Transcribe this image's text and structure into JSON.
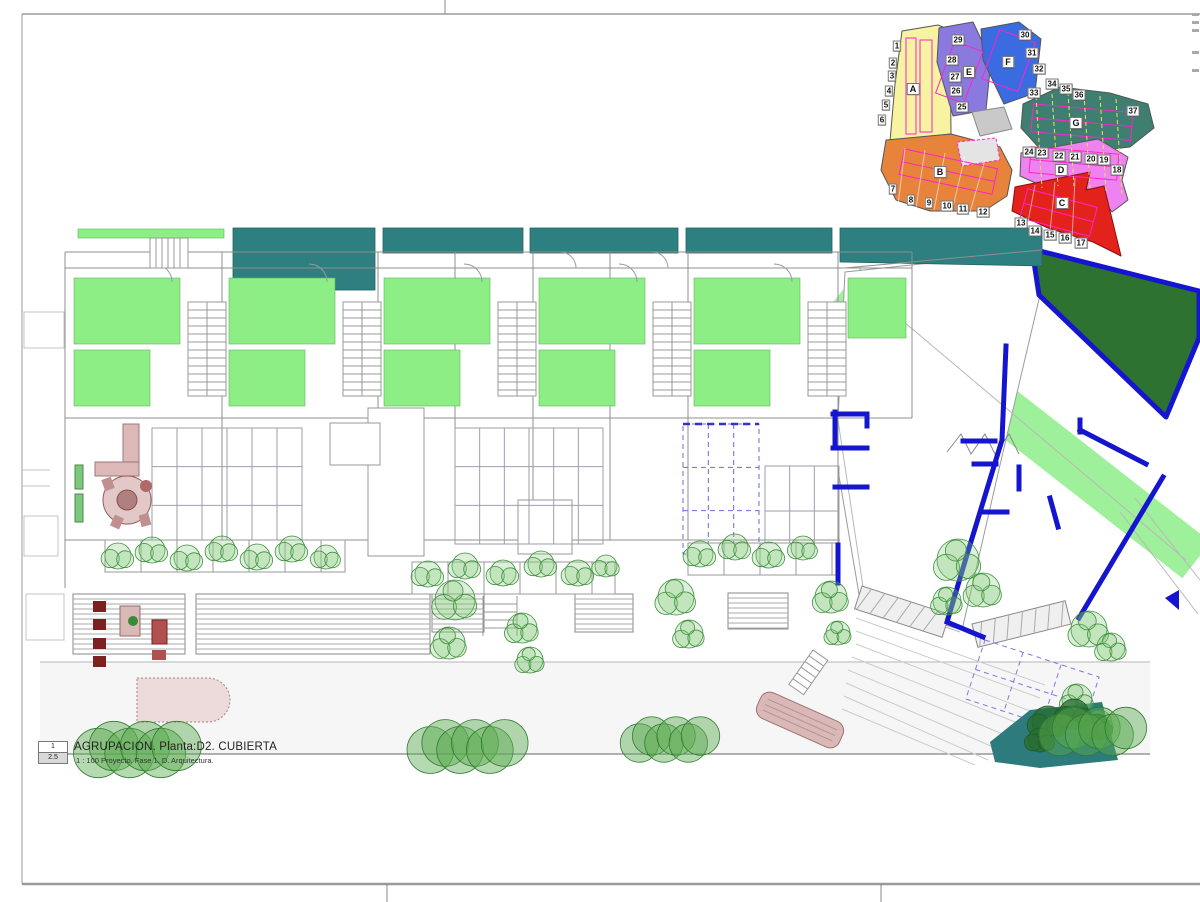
{
  "title_block": {
    "detail_number": "1",
    "scale_code": "2.5",
    "title": "AGRUPACION. Planta:D2. CUBIERTA",
    "subtitle": "1 : 100 Proyecto. Fase 1. D. Arquitectura."
  },
  "colors": {
    "teal_roof": "#2e7f80",
    "roof_green": "#8dee86",
    "lawn_green": "#9ff09a",
    "dark_green": "#2e7231",
    "accent_blue": "#1515cf",
    "pergola_dash_blue": "#6a6ade",
    "magenta_outline": "#ff22cc",
    "zone_a_yellow": "#f7f3a0",
    "zone_b_orange": "#e8833c",
    "zone_c_red": "#e3221c",
    "zone_d_violet": "#ee82ee",
    "zone_e_purple": "#8a7adf",
    "zone_f_blue": "#3a6be0",
    "zone_g_teal": "#3e7f72",
    "pool_pink": "#eddada",
    "furniture_rosy": "#d9b8b8"
  },
  "key_plan": {
    "zone_letters": [
      {
        "label": "A",
        "x": 913,
        "y": 89
      },
      {
        "label": "B",
        "x": 940,
        "y": 172
      },
      {
        "label": "C",
        "x": 1062,
        "y": 203
      },
      {
        "label": "D",
        "x": 1061,
        "y": 170
      },
      {
        "label": "E",
        "x": 969,
        "y": 72
      },
      {
        "label": "F",
        "x": 1008,
        "y": 62
      },
      {
        "label": "G",
        "x": 1076,
        "y": 123
      }
    ],
    "lot_tags": [
      {
        "n": "1",
        "x": 897,
        "y": 46
      },
      {
        "n": "2",
        "x": 893,
        "y": 63
      },
      {
        "n": "3",
        "x": 892,
        "y": 76
      },
      {
        "n": "4",
        "x": 889,
        "y": 91
      },
      {
        "n": "5",
        "x": 886,
        "y": 105
      },
      {
        "n": "6",
        "x": 882,
        "y": 120
      },
      {
        "n": "7",
        "x": 893,
        "y": 189
      },
      {
        "n": "8",
        "x": 911,
        "y": 200
      },
      {
        "n": "9",
        "x": 929,
        "y": 203
      },
      {
        "n": "10",
        "x": 947,
        "y": 206
      },
      {
        "n": "11",
        "x": 963,
        "y": 209
      },
      {
        "n": "12",
        "x": 983,
        "y": 212
      },
      {
        "n": "13",
        "x": 1021,
        "y": 223
      },
      {
        "n": "14",
        "x": 1035,
        "y": 231
      },
      {
        "n": "15",
        "x": 1050,
        "y": 235
      },
      {
        "n": "16",
        "x": 1065,
        "y": 238
      },
      {
        "n": "17",
        "x": 1081,
        "y": 243
      },
      {
        "n": "18",
        "x": 1117,
        "y": 170
      },
      {
        "n": "19",
        "x": 1104,
        "y": 160
      },
      {
        "n": "20",
        "x": 1091,
        "y": 159
      },
      {
        "n": "21",
        "x": 1075,
        "y": 157
      },
      {
        "n": "22",
        "x": 1059,
        "y": 156
      },
      {
        "n": "23",
        "x": 1042,
        "y": 153
      },
      {
        "n": "24",
        "x": 1029,
        "y": 152
      },
      {
        "n": "25",
        "x": 962,
        "y": 107
      },
      {
        "n": "26",
        "x": 956,
        "y": 91
      },
      {
        "n": "27",
        "x": 955,
        "y": 77
      },
      {
        "n": "28",
        "x": 952,
        "y": 60
      },
      {
        "n": "29",
        "x": 958,
        "y": 40
      },
      {
        "n": "30",
        "x": 1025,
        "y": 35
      },
      {
        "n": "31",
        "x": 1032,
        "y": 53
      },
      {
        "n": "32",
        "x": 1039,
        "y": 69
      },
      {
        "n": "33",
        "x": 1034,
        "y": 93
      },
      {
        "n": "34",
        "x": 1052,
        "y": 84
      },
      {
        "n": "35",
        "x": 1066,
        "y": 89
      },
      {
        "n": "36",
        "x": 1079,
        "y": 95
      },
      {
        "n": "37",
        "x": 1133,
        "y": 111
      }
    ]
  },
  "plan": {
    "grids": [
      {
        "x": 152,
        "y": 428,
        "w": 150,
        "h": 116,
        "cols": 6,
        "rows": 3,
        "dashed": false
      },
      {
        "x": 455,
        "y": 428,
        "w": 148,
        "h": 116,
        "cols": 6,
        "rows": 3,
        "dashed": false
      },
      {
        "x": 683,
        "y": 424,
        "w": 76,
        "h": 130,
        "cols": 3,
        "rows": 3,
        "dashed": true
      },
      {
        "x": 765,
        "y": 466,
        "w": 74,
        "h": 90,
        "cols": 3,
        "rows": 2,
        "dashed": false
      }
    ],
    "louvers": [
      {
        "x": 73,
        "y": 594,
        "w": 112,
        "h": 60
      },
      {
        "x": 196,
        "y": 594,
        "w": 234,
        "h": 60
      },
      {
        "x": 432,
        "y": 594,
        "w": 52,
        "h": 38
      },
      {
        "x": 575,
        "y": 594,
        "w": 58,
        "h": 38
      },
      {
        "x": 728,
        "y": 593,
        "w": 60,
        "h": 36
      }
    ],
    "planters": [
      {
        "x": 105,
        "y": 540,
        "w": 240
      },
      {
        "x": 412,
        "y": 562,
        "w": 203
      },
      {
        "x": 688,
        "y": 543,
        "w": 150
      }
    ],
    "shrubs": [
      {
        "x": 118,
        "y": 556,
        "r": 13
      },
      {
        "x": 152,
        "y": 550,
        "r": 13
      },
      {
        "x": 187,
        "y": 558,
        "r": 13
      },
      {
        "x": 222,
        "y": 549,
        "r": 13
      },
      {
        "x": 257,
        "y": 557,
        "r": 13
      },
      {
        "x": 292,
        "y": 549,
        "r": 13
      },
      {
        "x": 326,
        "y": 557,
        "r": 12
      },
      {
        "x": 428,
        "y": 574,
        "r": 13
      },
      {
        "x": 465,
        "y": 566,
        "r": 13
      },
      {
        "x": 503,
        "y": 573,
        "r": 13
      },
      {
        "x": 541,
        "y": 564,
        "r": 13
      },
      {
        "x": 578,
        "y": 573,
        "r": 13
      },
      {
        "x": 606,
        "y": 566,
        "r": 11
      },
      {
        "x": 700,
        "y": 554,
        "r": 13
      },
      {
        "x": 735,
        "y": 547,
        "r": 13
      },
      {
        "x": 769,
        "y": 555,
        "r": 13
      },
      {
        "x": 803,
        "y": 548,
        "r": 12
      }
    ],
    "trees": [
      {
        "x": 455,
        "y": 600,
        "r": 20
      },
      {
        "x": 449,
        "y": 643,
        "r": 16
      },
      {
        "x": 522,
        "y": 628,
        "r": 15
      },
      {
        "x": 530,
        "y": 660,
        "r": 13
      },
      {
        "x": 676,
        "y": 597,
        "r": 18
      },
      {
        "x": 689,
        "y": 634,
        "r": 14
      },
      {
        "x": 831,
        "y": 597,
        "r": 16
      },
      {
        "x": 838,
        "y": 633,
        "r": 12
      },
      {
        "x": 958,
        "y": 560,
        "r": 21
      },
      {
        "x": 983,
        "y": 590,
        "r": 17
      },
      {
        "x": 947,
        "y": 601,
        "r": 14
      },
      {
        "x": 1089,
        "y": 629,
        "r": 18
      },
      {
        "x": 1111,
        "y": 647,
        "r": 14
      },
      {
        "x": 1077,
        "y": 699,
        "r": 15
      },
      {
        "x": 1099,
        "y": 723,
        "r": 13
      }
    ],
    "dark_trees": [
      {
        "x": 1048,
        "y": 722,
        "r": 16
      },
      {
        "x": 1074,
        "y": 714,
        "r": 15
      },
      {
        "x": 1097,
        "y": 727,
        "r": 13
      },
      {
        "x": 1040,
        "y": 740,
        "r": 12
      }
    ],
    "bushes": [
      {
        "x": 140,
        "y": 750,
        "w": 95
      },
      {
        "x": 470,
        "y": 747,
        "w": 90
      },
      {
        "x": 672,
        "y": 740,
        "w": 74
      },
      {
        "x": 1095,
        "y": 732,
        "w": 80
      }
    ]
  }
}
